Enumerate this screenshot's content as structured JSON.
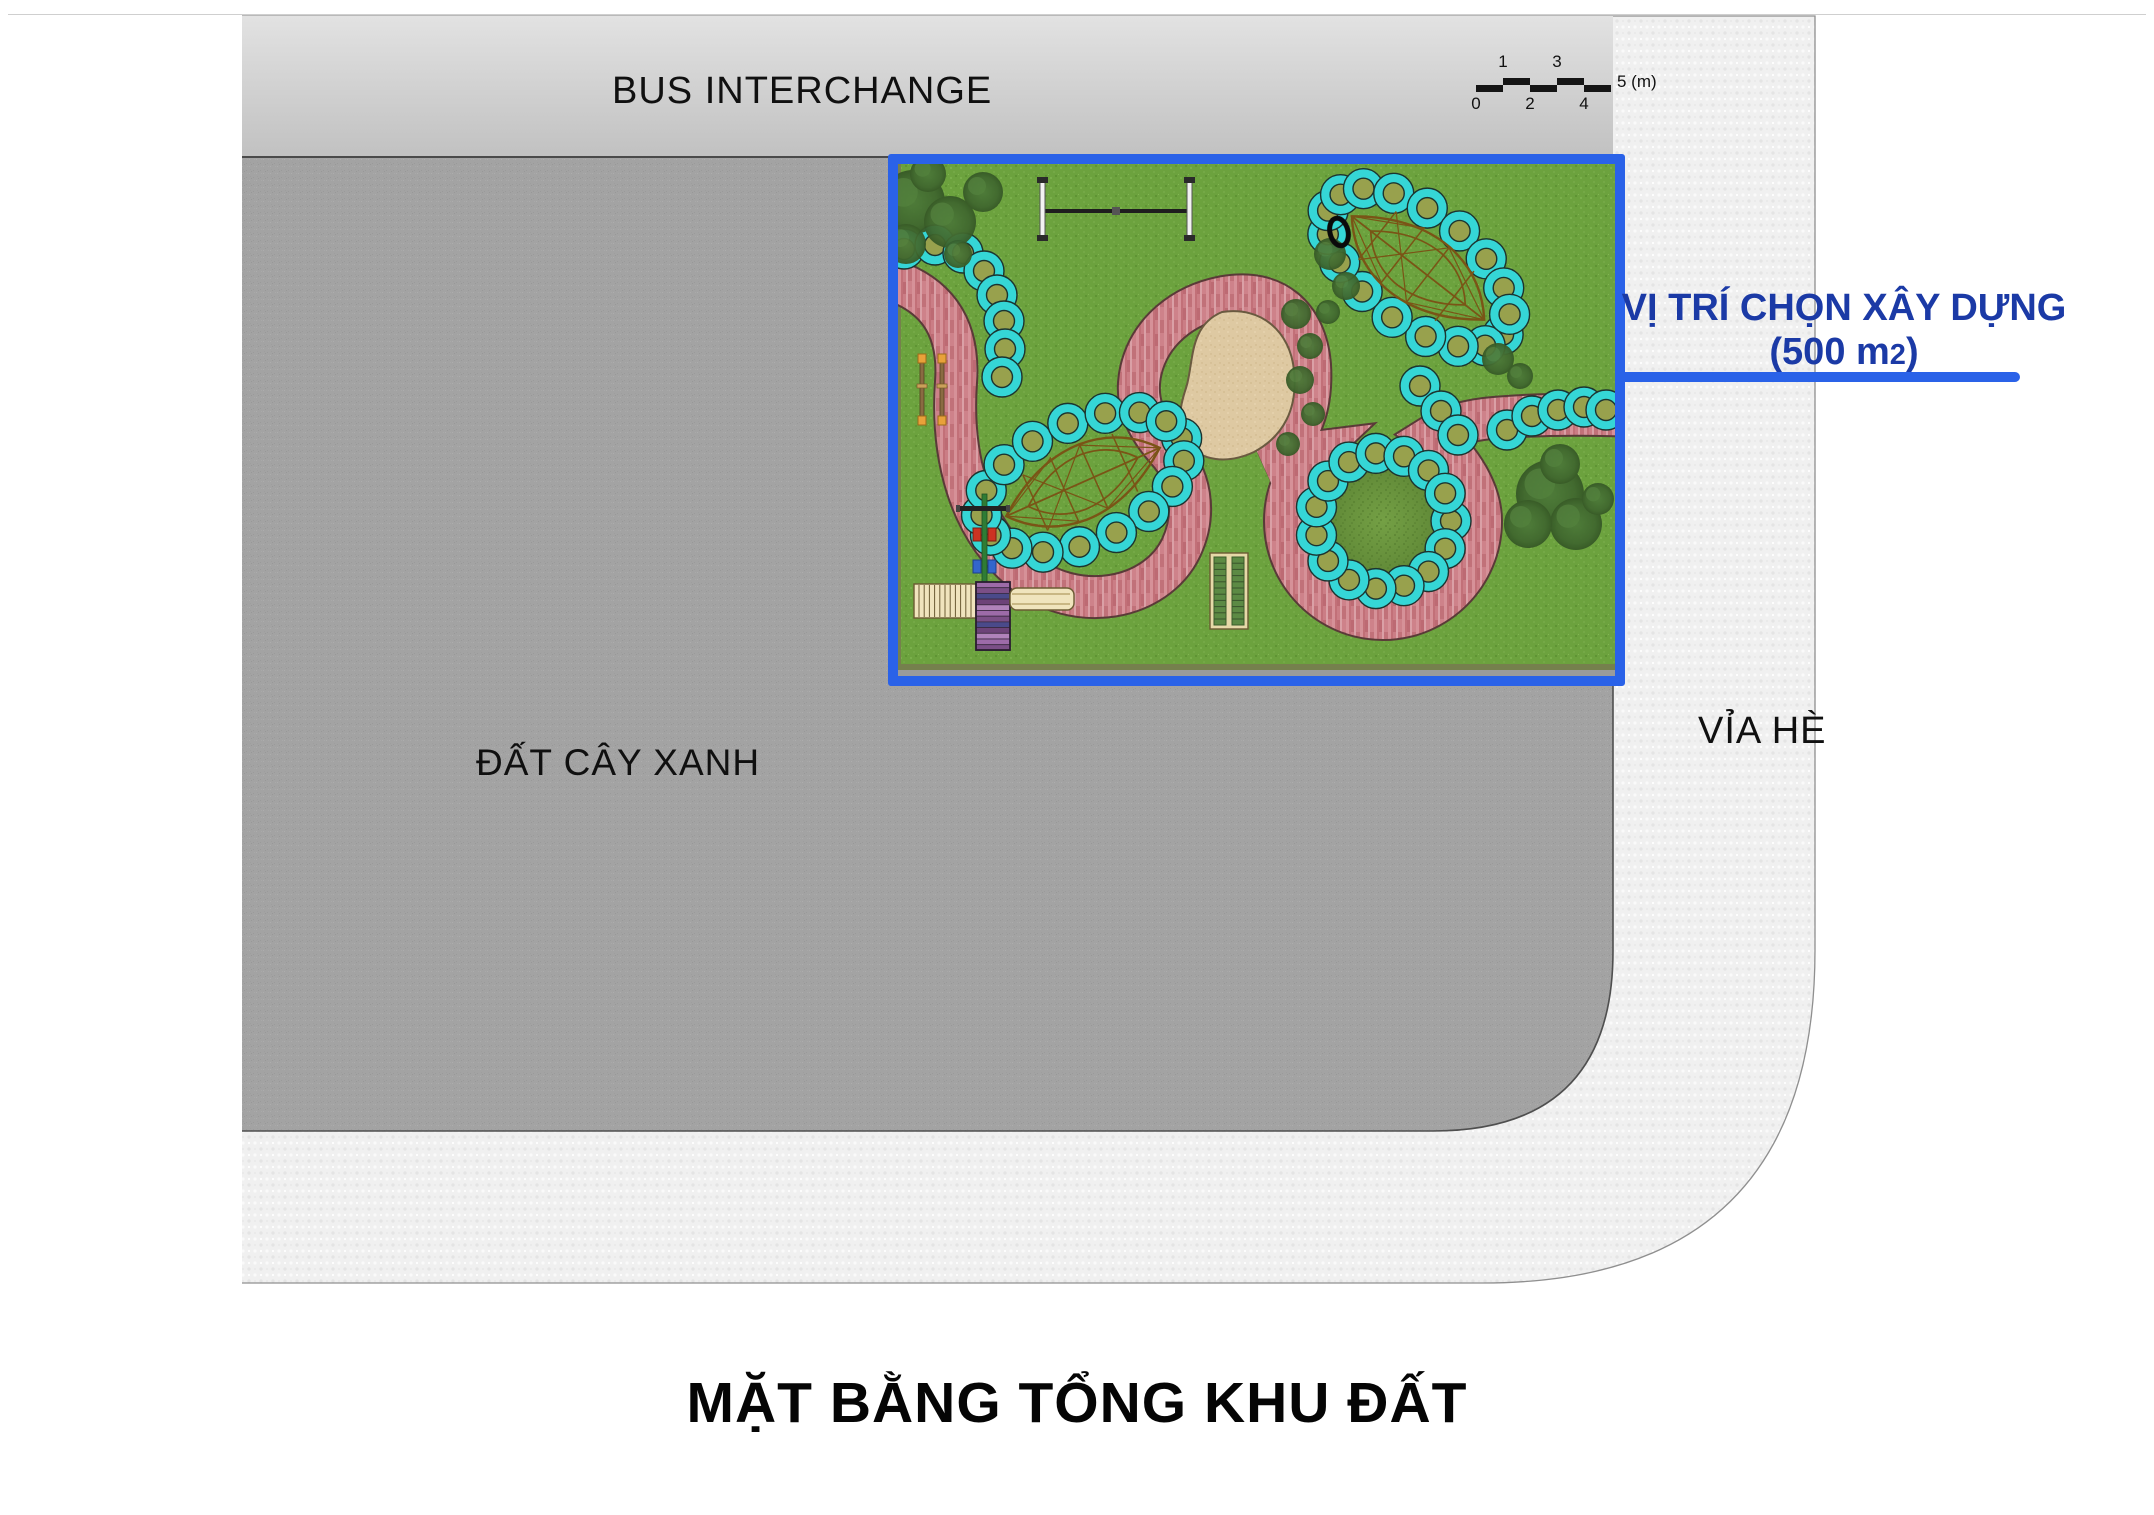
{
  "header": {
    "bus_interchange_label": "BUS INTERCHANGE"
  },
  "scale_bar": {
    "top_labels": [
      "1",
      "3"
    ],
    "bottom_labels": [
      "0",
      "2",
      "4"
    ],
    "end_label": "5 (m)"
  },
  "site": {
    "green_area_label": "ĐẤT CÂY XANH",
    "sidewalk_label": "VỈA HÈ"
  },
  "callout": {
    "line1": "VỊ TRÍ CHỌN XÂY DỰNG",
    "area_prefix": "(500 m",
    "area_sup": "2",
    "area_suffix": ")"
  },
  "title": "MẶT BẰNG TỔNG KHU ĐẤT",
  "colors": {
    "accent_blue": "#2a62e8",
    "callout_text_blue": "#1b3aa6",
    "parcel_gray": "#a3a3a3",
    "bus_band_gray": "#cccccc",
    "sidewalk_gray": "#f0f0f0",
    "grass_green": "#6ca23e",
    "path_pink": "#c8787f",
    "ring_cyan": "#35d6d6"
  }
}
